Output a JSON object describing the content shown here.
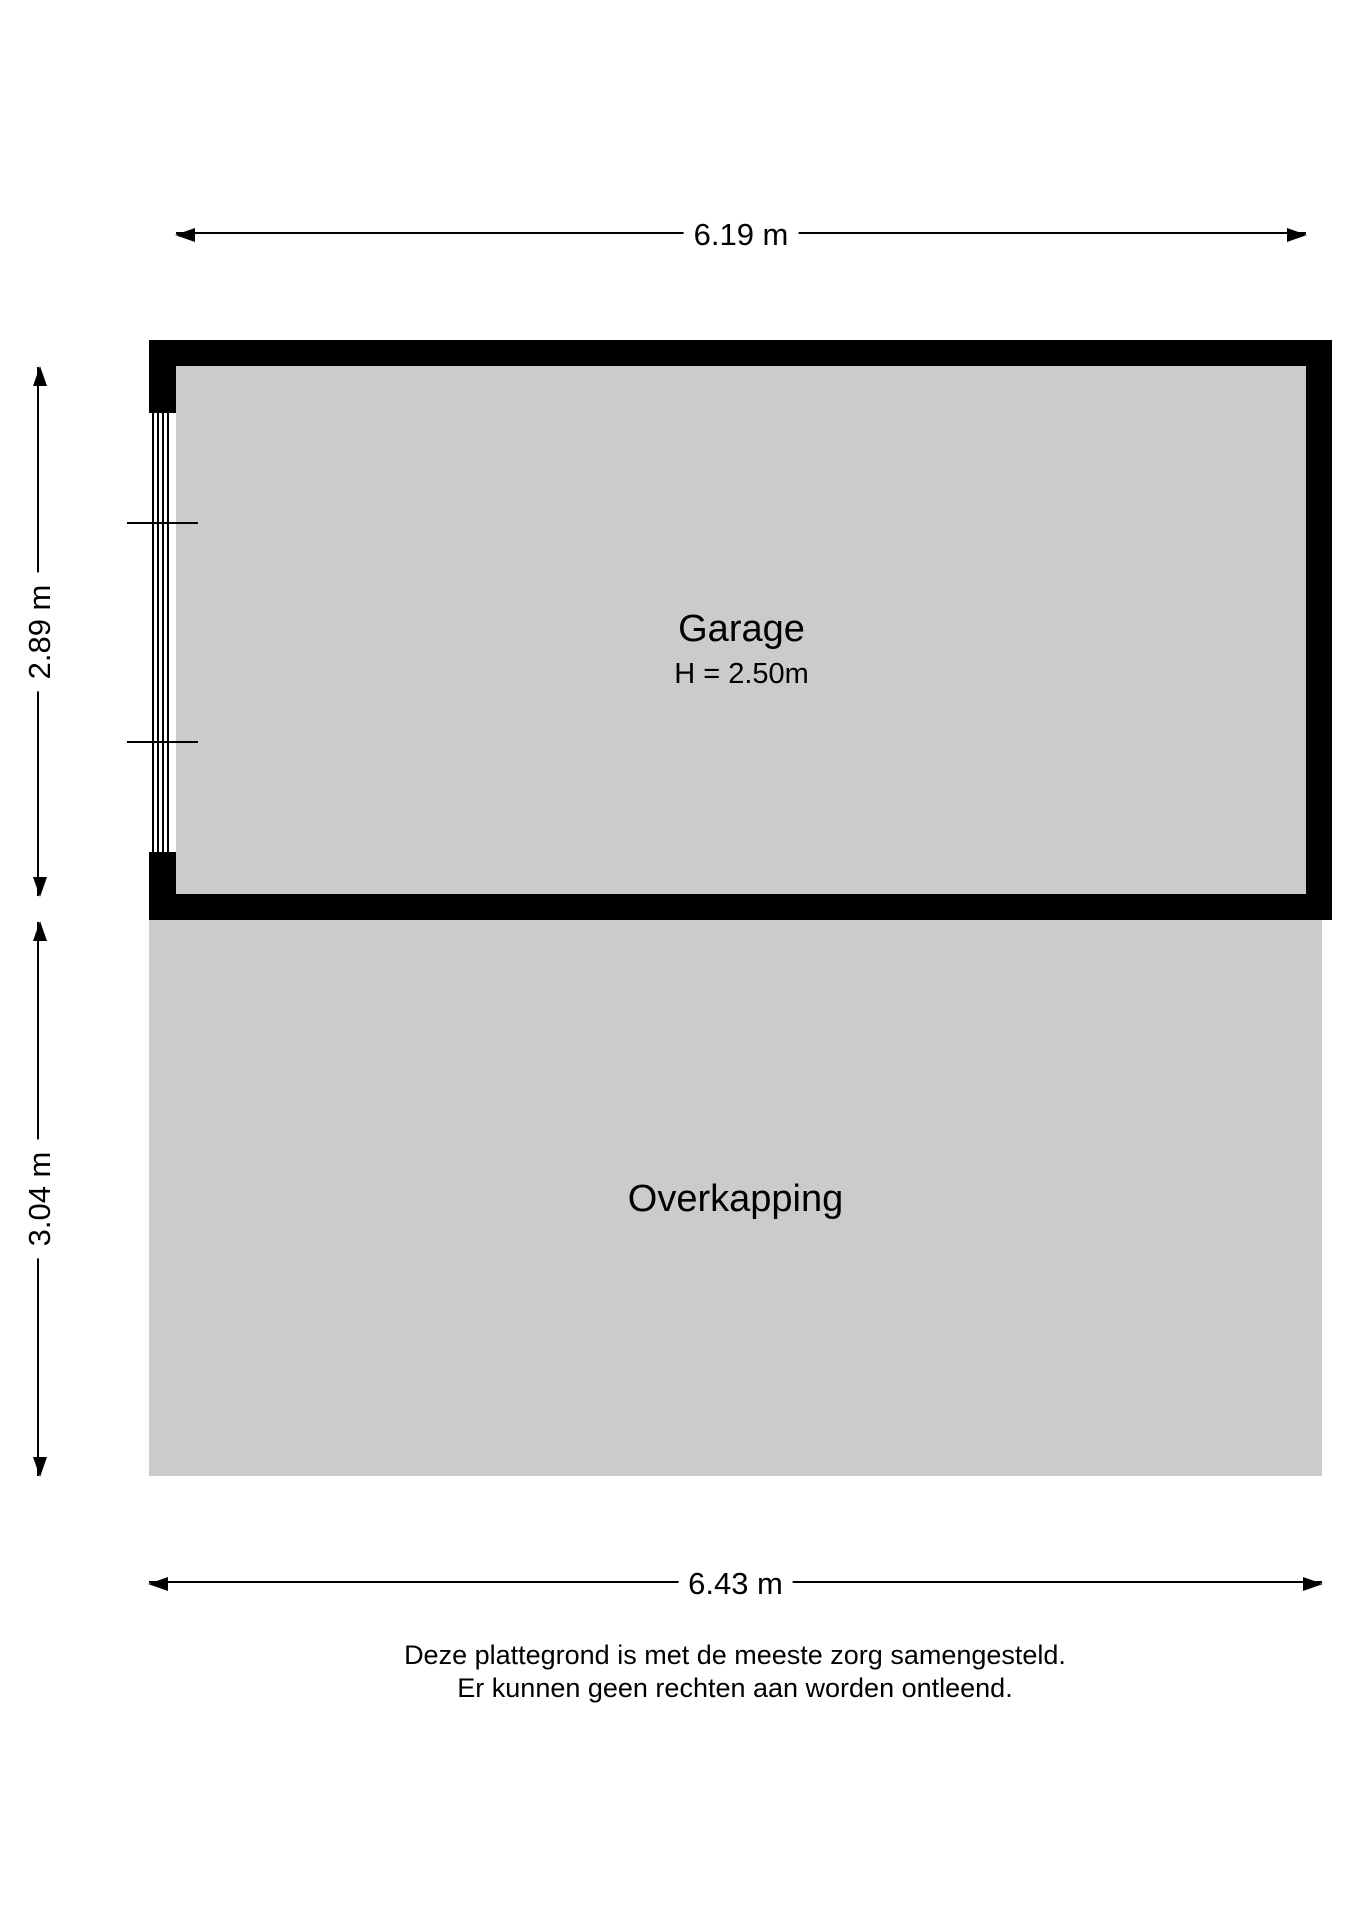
{
  "floorplan": {
    "rooms": {
      "garage": {
        "label": "Garage",
        "height": "H = 2.50m"
      },
      "overkapping": {
        "label": "Overkapping"
      }
    },
    "dimensions": {
      "top": "6.19 m",
      "left_upper": "2.89 m",
      "left_lower": "3.04 m",
      "bottom": "6.43 m"
    },
    "disclaimer": {
      "line1": "Deze plattegrond is met de meeste zorg samengesteld.",
      "line2": "Er kunnen geen rechten aan worden ontleend."
    },
    "colors": {
      "wall": "#000000",
      "floor": "#cbcbcb",
      "background": "#ffffff",
      "dimension_line": "#000000"
    }
  }
}
